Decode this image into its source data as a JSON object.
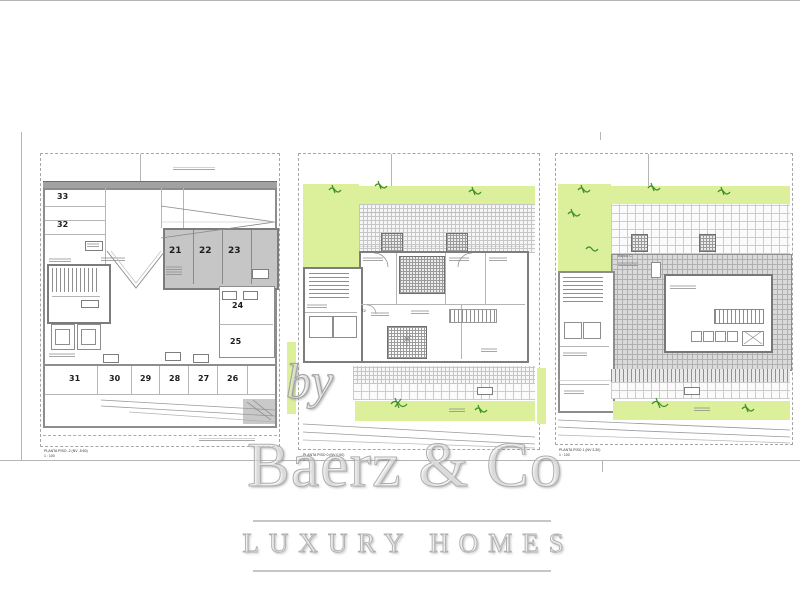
{
  "watermark": {
    "by": "by",
    "brand": "Baerz & Co",
    "tagline": "LUXURY HOMES"
  },
  "plans": {
    "garage": {
      "title": "PLANTA PISO -2 (NV -5.60)",
      "scale": "1 : 100",
      "spaces": [
        "33",
        "32",
        "21",
        "22",
        "23",
        "24",
        "25",
        "26",
        "27",
        "28",
        "29",
        "30",
        "31"
      ]
    },
    "floor": {
      "title": "PLANTA PISO 0 (NV 0.00)",
      "scale": "1 : 100",
      "unit_label": "T2"
    },
    "roof": {
      "title": "PLANTA PISO 1 (NV 3.30)",
      "scale": "1 : 100",
      "block_label": "Bloco C"
    }
  },
  "colors": {
    "lawn": "#dcef9a",
    "plant": "#3f8f2e",
    "roof_tile": "#dadada",
    "parking_fill": "#c6c6c6",
    "wall": "#8d8d8d"
  }
}
